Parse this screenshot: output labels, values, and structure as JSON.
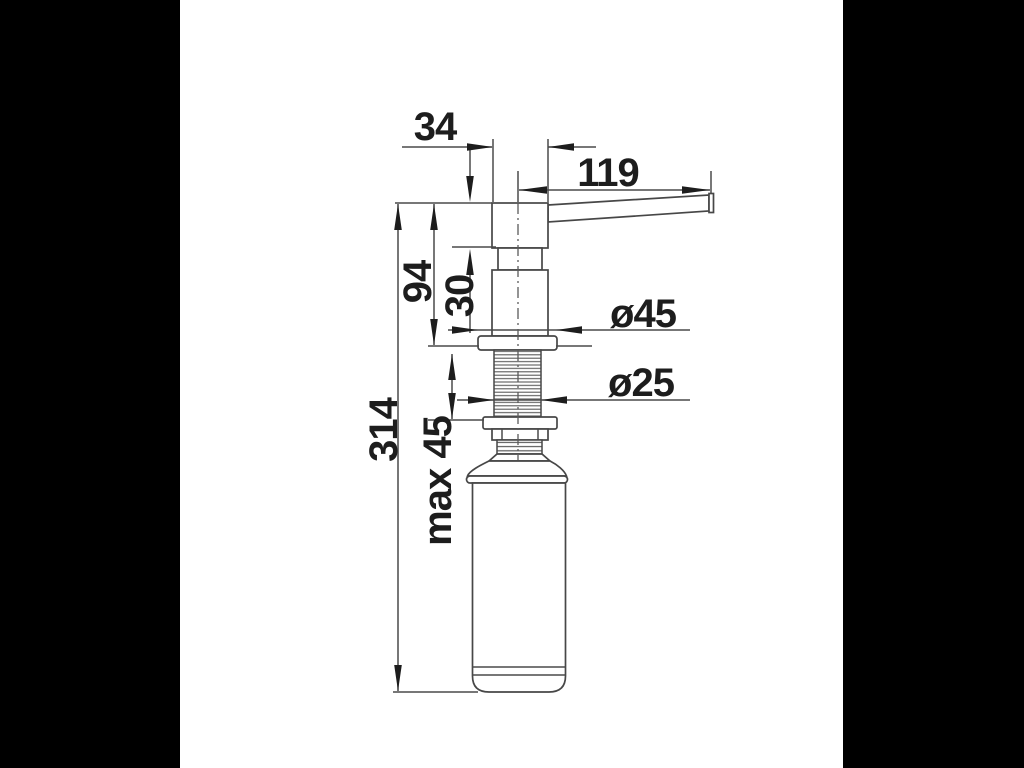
{
  "drawing": {
    "name": "soap-dispenser-dimension-drawing",
    "labels": {
      "head_width": "34",
      "spout_reach": "119",
      "above_counter_height": "94",
      "head_height": "30",
      "total_height": "314",
      "max_counter_thickness": "max 45",
      "flange_diameter": "ø45",
      "thread_diameter": "ø25"
    },
    "colors": {
      "background": "#000000",
      "canvas": "#ffffff",
      "line": "#4a4a4a",
      "ink": "#1d1d1d"
    }
  }
}
